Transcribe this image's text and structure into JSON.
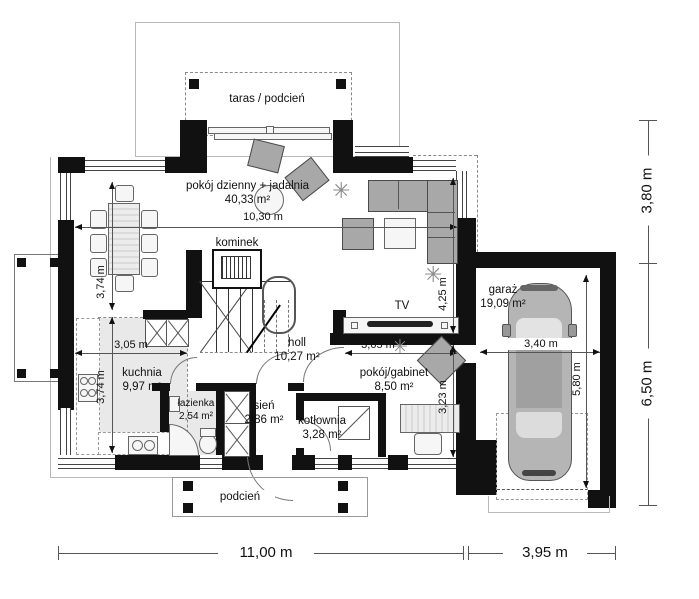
{
  "plan_title": "parter - rzut",
  "rooms": {
    "taras": {
      "name": "taras / podcień"
    },
    "living": {
      "name": "pokój dzienny + jadalnia",
      "area": "40,33 m²"
    },
    "kominek": {
      "name": "kominek"
    },
    "holl": {
      "name": "holl",
      "area": "10,27 m²"
    },
    "kuchnia": {
      "name": "kuchnia",
      "area": "9,97 m²"
    },
    "lazienka": {
      "name": "łazienka",
      "area": "2,54 m²"
    },
    "sien": {
      "name": "sień",
      "area": "2,86 m²"
    },
    "kotlownia": {
      "name": "kotłownia",
      "area": "3,28 m²"
    },
    "gabinet": {
      "name": "pokój/gabinet",
      "area": "8,50 m²"
    },
    "garaz": {
      "name": "garaż",
      "area": "19,09 m²"
    },
    "podcien": {
      "name": "podcień"
    },
    "tv": {
      "label": "TV"
    }
  },
  "dimensions": {
    "living_width": "10,30 m",
    "dining_depth": "3,74 m",
    "kitchen_depth": "3,74 m",
    "kitchen_width": "3,05 m",
    "gabinet_width": "3,05 m",
    "living_right_depth": "4,25 m",
    "gabinet_depth": "3,23 m",
    "garage_width": "3,40 m",
    "garage_depth": "5,80 m",
    "right_top": "3,80 m",
    "right_bottom": "6,50 m",
    "bottom_house": "11,00 m",
    "bottom_garage": "3,95 m"
  },
  "colors": {
    "wall": "#111111",
    "room_shade": "#e9e9e9",
    "furniture": "#a8a8a8",
    "dimension_text": "#1a1a1a"
  },
  "icons": {
    "plant": "✳"
  }
}
